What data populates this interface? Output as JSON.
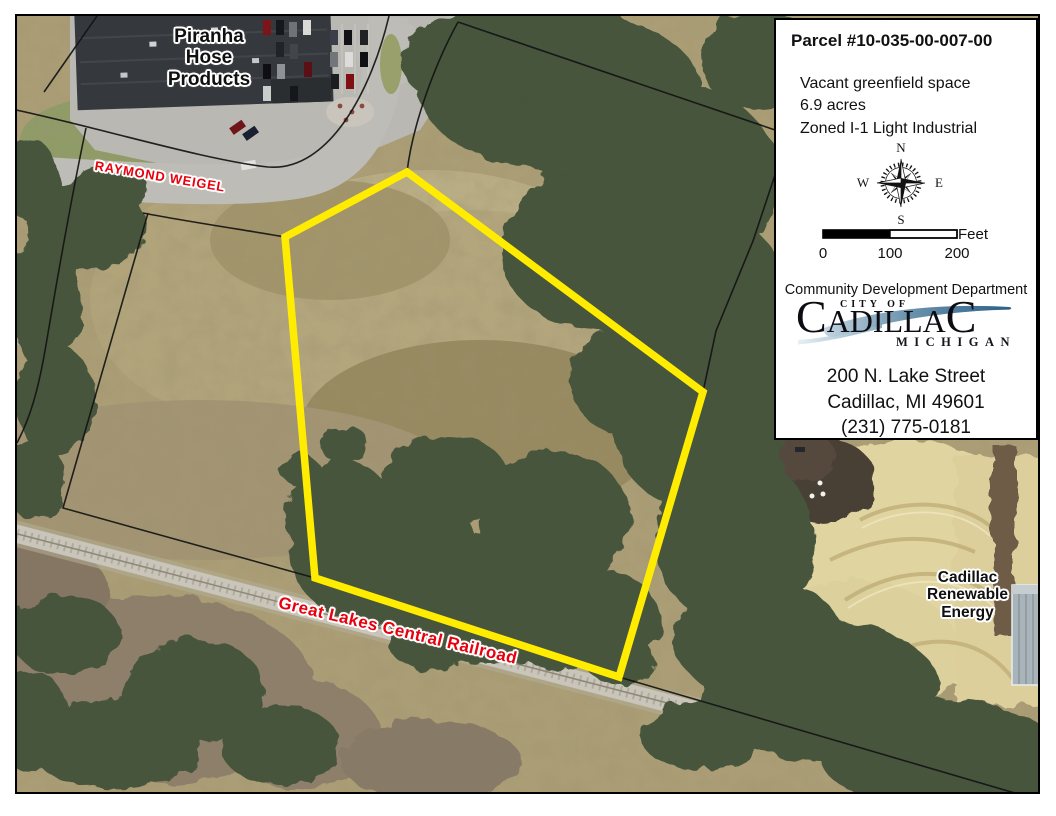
{
  "map": {
    "labels": {
      "piranha": [
        "Piranha",
        "Hose",
        "Products"
      ],
      "street": "RAYMOND WEIGEL",
      "railroad": "Great Lakes Central Railroad",
      "renewable_energy": [
        "Cadillac",
        "Renewable",
        "Energy"
      ]
    },
    "parcel_outline_color": "#ffec00",
    "street_label_color": "#e8000d"
  },
  "info_box": {
    "title": "Parcel #10-035-00-007-00",
    "details": [
      "Vacant greenfield space",
      "6.9 acres",
      "Zoned I-1 Light Industrial"
    ],
    "compass": {
      "north": "N",
      "east": "E",
      "south": "S",
      "west": "W"
    },
    "scale": {
      "ticks": [
        "0",
        "100",
        "200"
      ],
      "unit": "Feet"
    },
    "department": "Community Development Department",
    "logo": {
      "city_of": "CITY OF",
      "city_initial": "C",
      "city_middle": "ADILLA",
      "city_final": "C",
      "state": "MICHIGAN",
      "swoosh_color": "#4e7f9e"
    },
    "address": [
      "200 N. Lake Street",
      "Cadillac, MI 49601",
      "(231) 775-0181"
    ]
  }
}
